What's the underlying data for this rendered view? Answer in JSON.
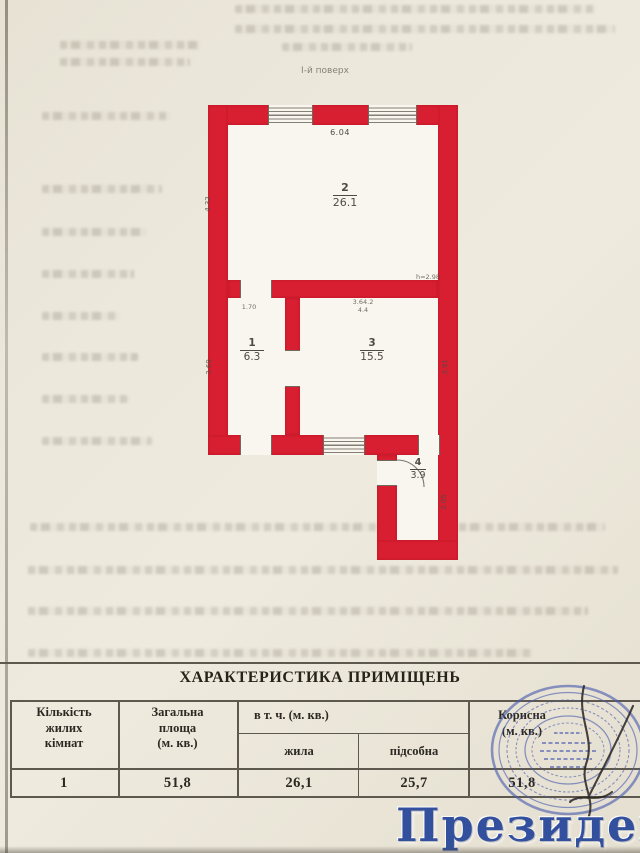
{
  "colors": {
    "plan_red": "#d81f31",
    "stamp_blue": "#4a5cae",
    "watermark_blue": "#33509e"
  },
  "floor_label": "І-й поверх",
  "plan": {
    "dim_top": "6.04",
    "height_note": "h=2.98",
    "room2": {
      "number": "2",
      "area": "26.1"
    },
    "room1": {
      "number": "1",
      "area": "6.3"
    },
    "room3": {
      "number": "3",
      "area": "15.5"
    },
    "room4": {
      "number": "4",
      "area": "3.9"
    },
    "dims": {
      "room2_left": "4.32",
      "room1_top": "1.70",
      "room1_left": "3.69",
      "room3_top": "3.64.2\n4.4",
      "room3_right": "3.91",
      "room4_right": "2.05"
    }
  },
  "table": {
    "title": "ХАРАКТЕРИСТИКА ПРИМІЩЕНЬ",
    "headers": {
      "rooms": "Кількість\nжилих\nкімнат",
      "total": "Загальна\nплоща\n(м. кв.)",
      "including": "в т. ч. (м. кв.)",
      "living": "жила",
      "auxiliary": "підсобна",
      "useful": "Корисна\n(м. кв.)"
    },
    "row": {
      "rooms": "1",
      "total": "51,8",
      "living": "26,1",
      "auxiliary": "25,7",
      "useful": "51,8"
    }
  },
  "watermark": "Президент"
}
